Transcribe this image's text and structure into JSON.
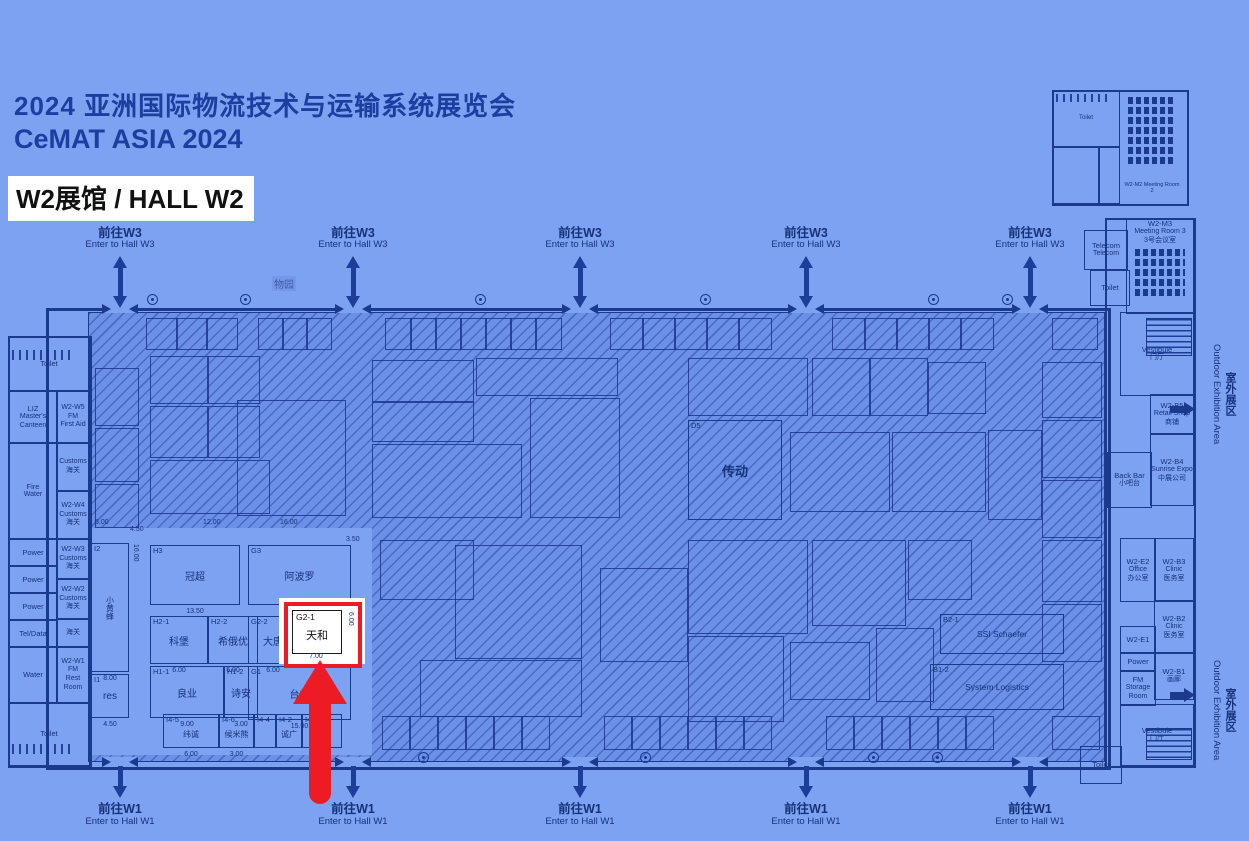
{
  "header": {
    "title_cn": "2024 亚洲国际物流技术与运输系统展览会",
    "title_en": "CeMAT ASIA 2024",
    "hall_label": "W2展馆  / HALL W2"
  },
  "nav": {
    "top_cn": "前往W3",
    "top_en": "Enter to Hall W3",
    "bottom_cn": "前往W1",
    "bottom_en": "Enter to Hall W1"
  },
  "outdoor": {
    "cn": "室外展区",
    "en": "Outdoor Exhibition Area"
  },
  "garden_label": "物园",
  "left_rooms_a": [
    {
      "lines": [
        "Toilet"
      ]
    },
    {
      "lines": [
        "LIZ",
        "Master's Canteen"
      ]
    },
    {
      "lines": [
        "Fire",
        "Water"
      ]
    },
    {
      "lines": [
        "Power"
      ]
    },
    {
      "lines": [
        "Power"
      ]
    },
    {
      "lines": [
        "Power"
      ]
    },
    {
      "lines": [
        "Tel/Data"
      ]
    },
    {
      "lines": [
        "Water"
      ]
    },
    {
      "lines": [
        "Toilet"
      ]
    }
  ],
  "left_rooms_b": [
    {
      "lines": [
        "W2-W5",
        "FM",
        "First Aid"
      ]
    },
    {
      "lines": [
        "Customs",
        "海关"
      ]
    },
    {
      "lines": [
        "W2-W4",
        "Customs",
        "海关"
      ]
    },
    {
      "lines": [
        "W2-W3",
        "Customs",
        "海关"
      ]
    },
    {
      "lines": [
        "W2-W2",
        "Customs",
        "海关"
      ]
    },
    {
      "lines": [
        "海关"
      ]
    },
    {
      "lines": [
        "W2-W1",
        "FM",
        "Rest Room"
      ]
    }
  ],
  "right_rooms": [
    {
      "lines": [
        "Telecom",
        "Telecom"
      ]
    },
    {
      "lines": [
        "Toilet"
      ]
    },
    {
      "lines": [
        "W2-M3",
        "Meeting Room 3",
        "3号会议室"
      ]
    },
    {
      "lines": [
        "Vestibule",
        "门厅"
      ]
    },
    {
      "lines": [
        "W2-B5",
        "Retail Shop",
        "商铺"
      ]
    },
    {
      "lines": [
        "W2-B4",
        "Sunrise Expo",
        "中展公司"
      ]
    },
    {
      "lines": [
        "Back Bar",
        "小吧台"
      ]
    },
    {
      "lines": [
        "W2-E2",
        "Office",
        "办公室"
      ]
    },
    {
      "lines": [
        "W2-B3",
        "Clinic",
        "医务室"
      ]
    },
    {
      "lines": [
        "W2-B2",
        "Clinic",
        "医务室"
      ]
    },
    {
      "lines": [
        "W2-E1"
      ]
    },
    {
      "lines": [
        "Power"
      ]
    },
    {
      "lines": [
        "W2-B1",
        "画廊"
      ]
    },
    {
      "lines": [
        "FM",
        "Storage Room"
      ]
    },
    {
      "lines": [
        "Vestibule",
        "门厅"
      ]
    },
    {
      "lines": [
        "Toilet"
      ]
    }
  ],
  "mini_plan": {
    "toilet": "Toilet",
    "meeting": "W2-M2",
    "meeting2": "Meeting Room 2"
  },
  "booths": [
    {
      "id": "I2",
      "name": "小黄蜂",
      "dim": "8.00",
      "dim_side": "16.00"
    },
    {
      "id": "H3",
      "name": "冠超",
      "dim": "13.50"
    },
    {
      "id": "G3",
      "name": "阿波罗",
      "dim": "14.50"
    },
    {
      "id": "H2-1",
      "name": "科堡",
      "dim": "6.00"
    },
    {
      "id": "H2-2",
      "name": "希俄优",
      "dim": "6.00"
    },
    {
      "id": "G2-2",
      "name": "大唐",
      "dim": "6.00"
    },
    {
      "id": "H1-1",
      "name": "良业",
      "dim": "9.00"
    },
    {
      "id": "H1-2",
      "name": "诗安",
      "dim": "3.00"
    },
    {
      "id": "G1",
      "name": "台朗",
      "dim": "15.00"
    },
    {
      "id": "I1",
      "name": "res",
      "dim": "4.50"
    },
    {
      "id": "I4-5",
      "name": "纬诚",
      "dim": "6.00"
    },
    {
      "id": "I4-6",
      "name": "候米熊",
      "dim": "3.00"
    },
    {
      "id": "I4-4",
      "name": "",
      "dim": ""
    },
    {
      "id": "I4-2",
      "name": "诚广",
      "dim": ""
    },
    {
      "id": "I4-1",
      "name": "易卡",
      "dim": ""
    },
    {
      "id": "D5",
      "name": "传动",
      "dim": ""
    },
    {
      "id": "B2-1",
      "name": "SSI Schaefer",
      "dim": ""
    },
    {
      "id": "B1-2",
      "name": "System Logistics",
      "dim": ""
    }
  ],
  "highlight": {
    "id": "G2-1",
    "name": "天和",
    "dim": "7.00",
    "dim_side": "6.00"
  },
  "dim_marks": [
    "5.00",
    "4.50",
    "12.00",
    "16.00",
    "3.50"
  ],
  "colors": {
    "bg": "#7da2f1",
    "ink": "#15337d",
    "wall": "#1a3a8e",
    "red": "#ed1c24",
    "title": "#1b3fa0",
    "white": "#ffffff"
  }
}
